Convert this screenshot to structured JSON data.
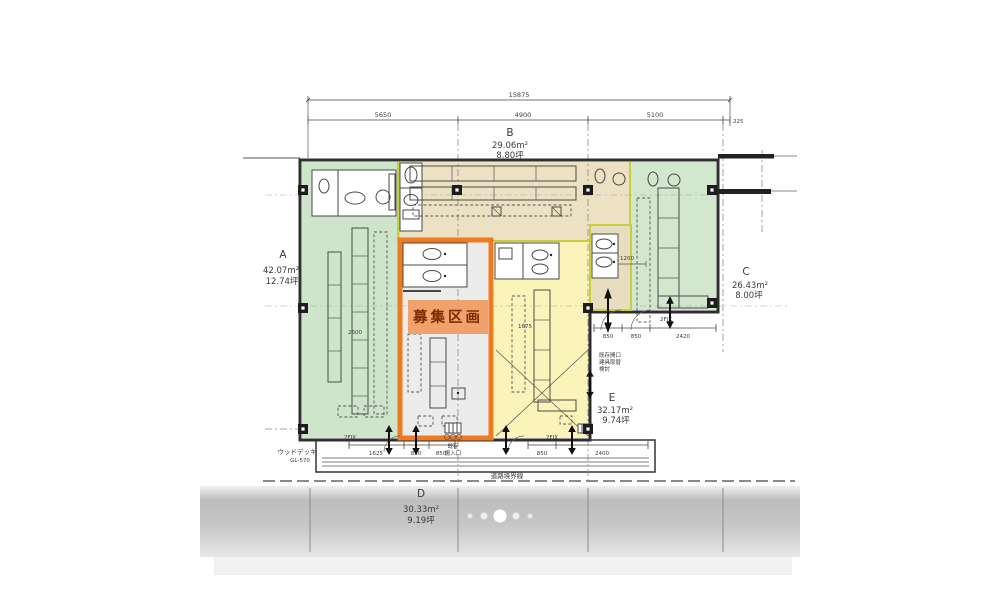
{
  "viewer": {
    "background": "#ffffff",
    "band_top_color": "#bdbdbd",
    "band_bottom_color": "#e7e7e7"
  },
  "carousel": {
    "dot_count": 5,
    "active_index": 2
  },
  "plan": {
    "highlight": {
      "label": "募集区画",
      "border_color": "#ee7a22",
      "fill": "#f2a06c",
      "text_color": "#7c2d00"
    },
    "sections": {
      "a": {
        "id": "A",
        "m2": "42.07m²",
        "tsubo": "12.74坪"
      },
      "b": {
        "id": "B",
        "m2": "29.06m²",
        "tsubo": "8.80坪"
      },
      "c": {
        "id": "C",
        "m2": "26.43m²",
        "tsubo": "8.00坪"
      },
      "d": {
        "id": "D",
        "m2": "30.33m²",
        "tsubo": "9.19坪"
      },
      "e": {
        "id": "E",
        "m2": "32.17m²",
        "tsubo": "9.74坪"
      }
    },
    "dims": {
      "overall": "15875",
      "seg1": "5650",
      "seg2": "4900",
      "seg3": "5100",
      "seg4": "225",
      "b1": "1625",
      "b2": "850",
      "b3": "850",
      "b4": "850",
      "b5": "2400",
      "r1": "850",
      "r2": "850",
      "r3": "2420",
      "i1": "2600",
      "i2": "1675",
      "i3": "1200",
      "fix": "2FIX"
    },
    "notes": {
      "wood_deck": "ウッドデッキ",
      "gl": "GL-570",
      "road": "道路境界線",
      "entry1": "既存",
      "entry2": "搬入口",
      "e1": "既存開口",
      "e2": "建具取替",
      "e3": "検討"
    },
    "colors": {
      "green": "#cfe5cb",
      "green2": "#d2e7ce",
      "beige": "#ede1c4",
      "deck": "#e9ddbe",
      "yellow": "#faf4ba",
      "gray_unit": "#ececec",
      "wall": "#2f2f2f",
      "lime_border": "#c9cf3a"
    }
  }
}
